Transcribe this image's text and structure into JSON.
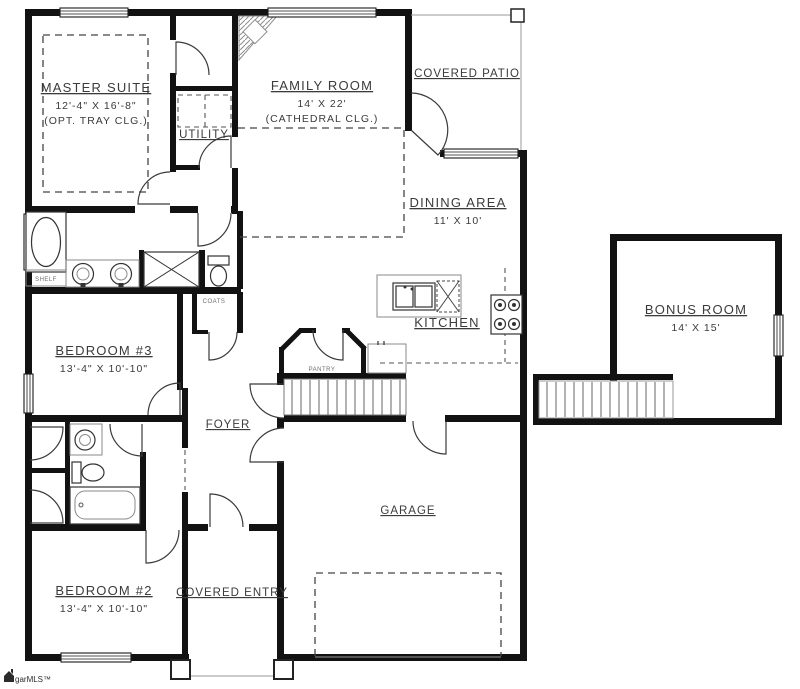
{
  "plan": {
    "rooms": {
      "master_suite": {
        "name": "MASTER SUITE",
        "dims": "12'-4\" X 16'-8\"",
        "note": "(OPT. TRAY CLG.)"
      },
      "family_room": {
        "name": "FAMILY ROOM",
        "dims": "14' X 22'",
        "note": "(CATHEDRAL CLG.)"
      },
      "covered_patio": {
        "name": "COVERED PATIO"
      },
      "dining_area": {
        "name": "DINING AREA",
        "dims": "11' X 10'"
      },
      "utility": {
        "name": "UTILITY"
      },
      "kitchen": {
        "name": "KITCHEN"
      },
      "pantry": {
        "name": "PANTRY"
      },
      "coats": {
        "name": "COATS"
      },
      "shelf": {
        "name": "SHELF"
      },
      "bedroom_3": {
        "name": "BEDROOM #3",
        "dims": "13'-4\" X 10'-10\""
      },
      "foyer": {
        "name": "FOYER"
      },
      "bonus_room": {
        "name": "BONUS ROOM",
        "dims": "14' X 15'"
      },
      "garage": {
        "name": "GARAGE"
      },
      "bedroom_2": {
        "name": "BEDROOM #2",
        "dims": "13'-4\" X 10'-10\""
      },
      "covered_entry": {
        "name": "COVERED ENTRY"
      }
    },
    "watermark": "garMLS™",
    "colors": {
      "wall": "#121212",
      "line": "#4a4a4a",
      "text": "#3b3b3b"
    }
  }
}
